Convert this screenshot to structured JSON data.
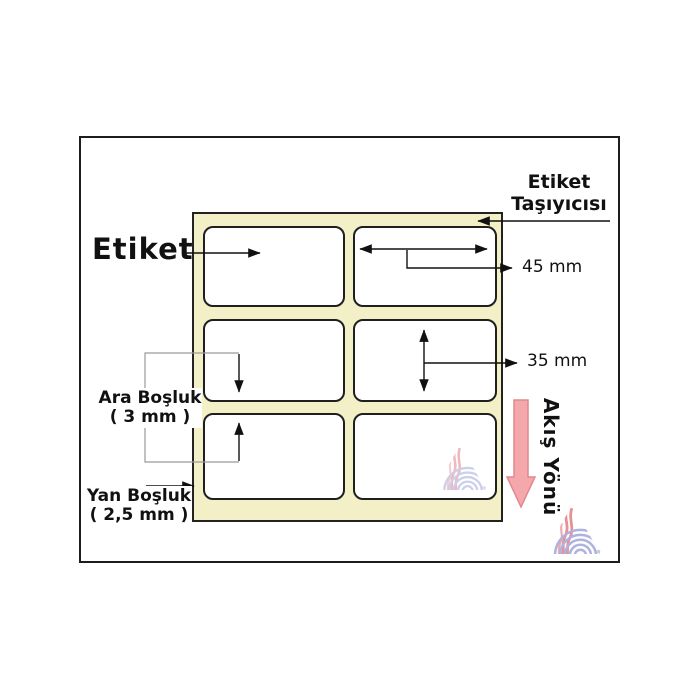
{
  "diagram": {
    "title_label": "Etiket",
    "carrier": {
      "line1": "Etiket",
      "line2": "Taşıyıcısı"
    },
    "dimensions": {
      "label_width": "45 mm",
      "label_height": "35 mm"
    },
    "gap": {
      "label": "Ara Boşluk",
      "value": "( 3 mm )"
    },
    "side_margin": {
      "label": "Yan Boşluk",
      "value": "( 2,5 mm )"
    },
    "flow": {
      "label": "Akış Yönü"
    },
    "labels_grid": {
      "columns": 2,
      "rows": 3,
      "count": 6
    }
  },
  "colors": {
    "carrier_fill": "#f3efc7",
    "label_fill": "#ffffff",
    "outline": "#1d1d1d",
    "flow_arrow_fill": "#f4a8ac",
    "flow_arrow_stroke": "#e2888e",
    "bracket_gray": "#9a9a9a",
    "watermark_red": "#e0767c",
    "watermark_blue": "#9ba0d6"
  },
  "icons": {
    "flow_arrow": "down-arrow",
    "watermark": "brand-watermark-triangle"
  }
}
